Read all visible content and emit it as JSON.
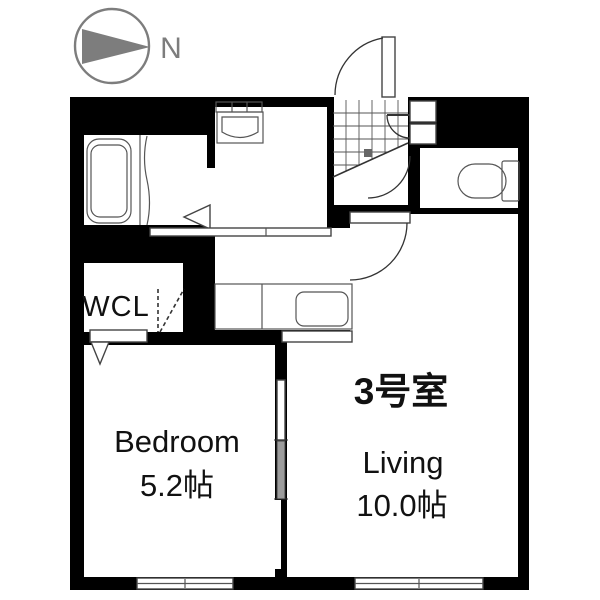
{
  "compass": {
    "label": "N"
  },
  "unit": {
    "room_number": "3号室"
  },
  "rooms": {
    "wcl": {
      "label": "WCL"
    },
    "bedroom": {
      "label": "Bedroom",
      "size": "5.2帖"
    },
    "living": {
      "label": "Living",
      "size": "10.0帖"
    }
  },
  "colors": {
    "background": "#ffffff",
    "wall_black": "#000000",
    "compass_gray": "#7d7d7d",
    "fixture_gray": "#555555",
    "sliding_panel_gray": "#9c9c9c",
    "text_black": "#111111"
  }
}
